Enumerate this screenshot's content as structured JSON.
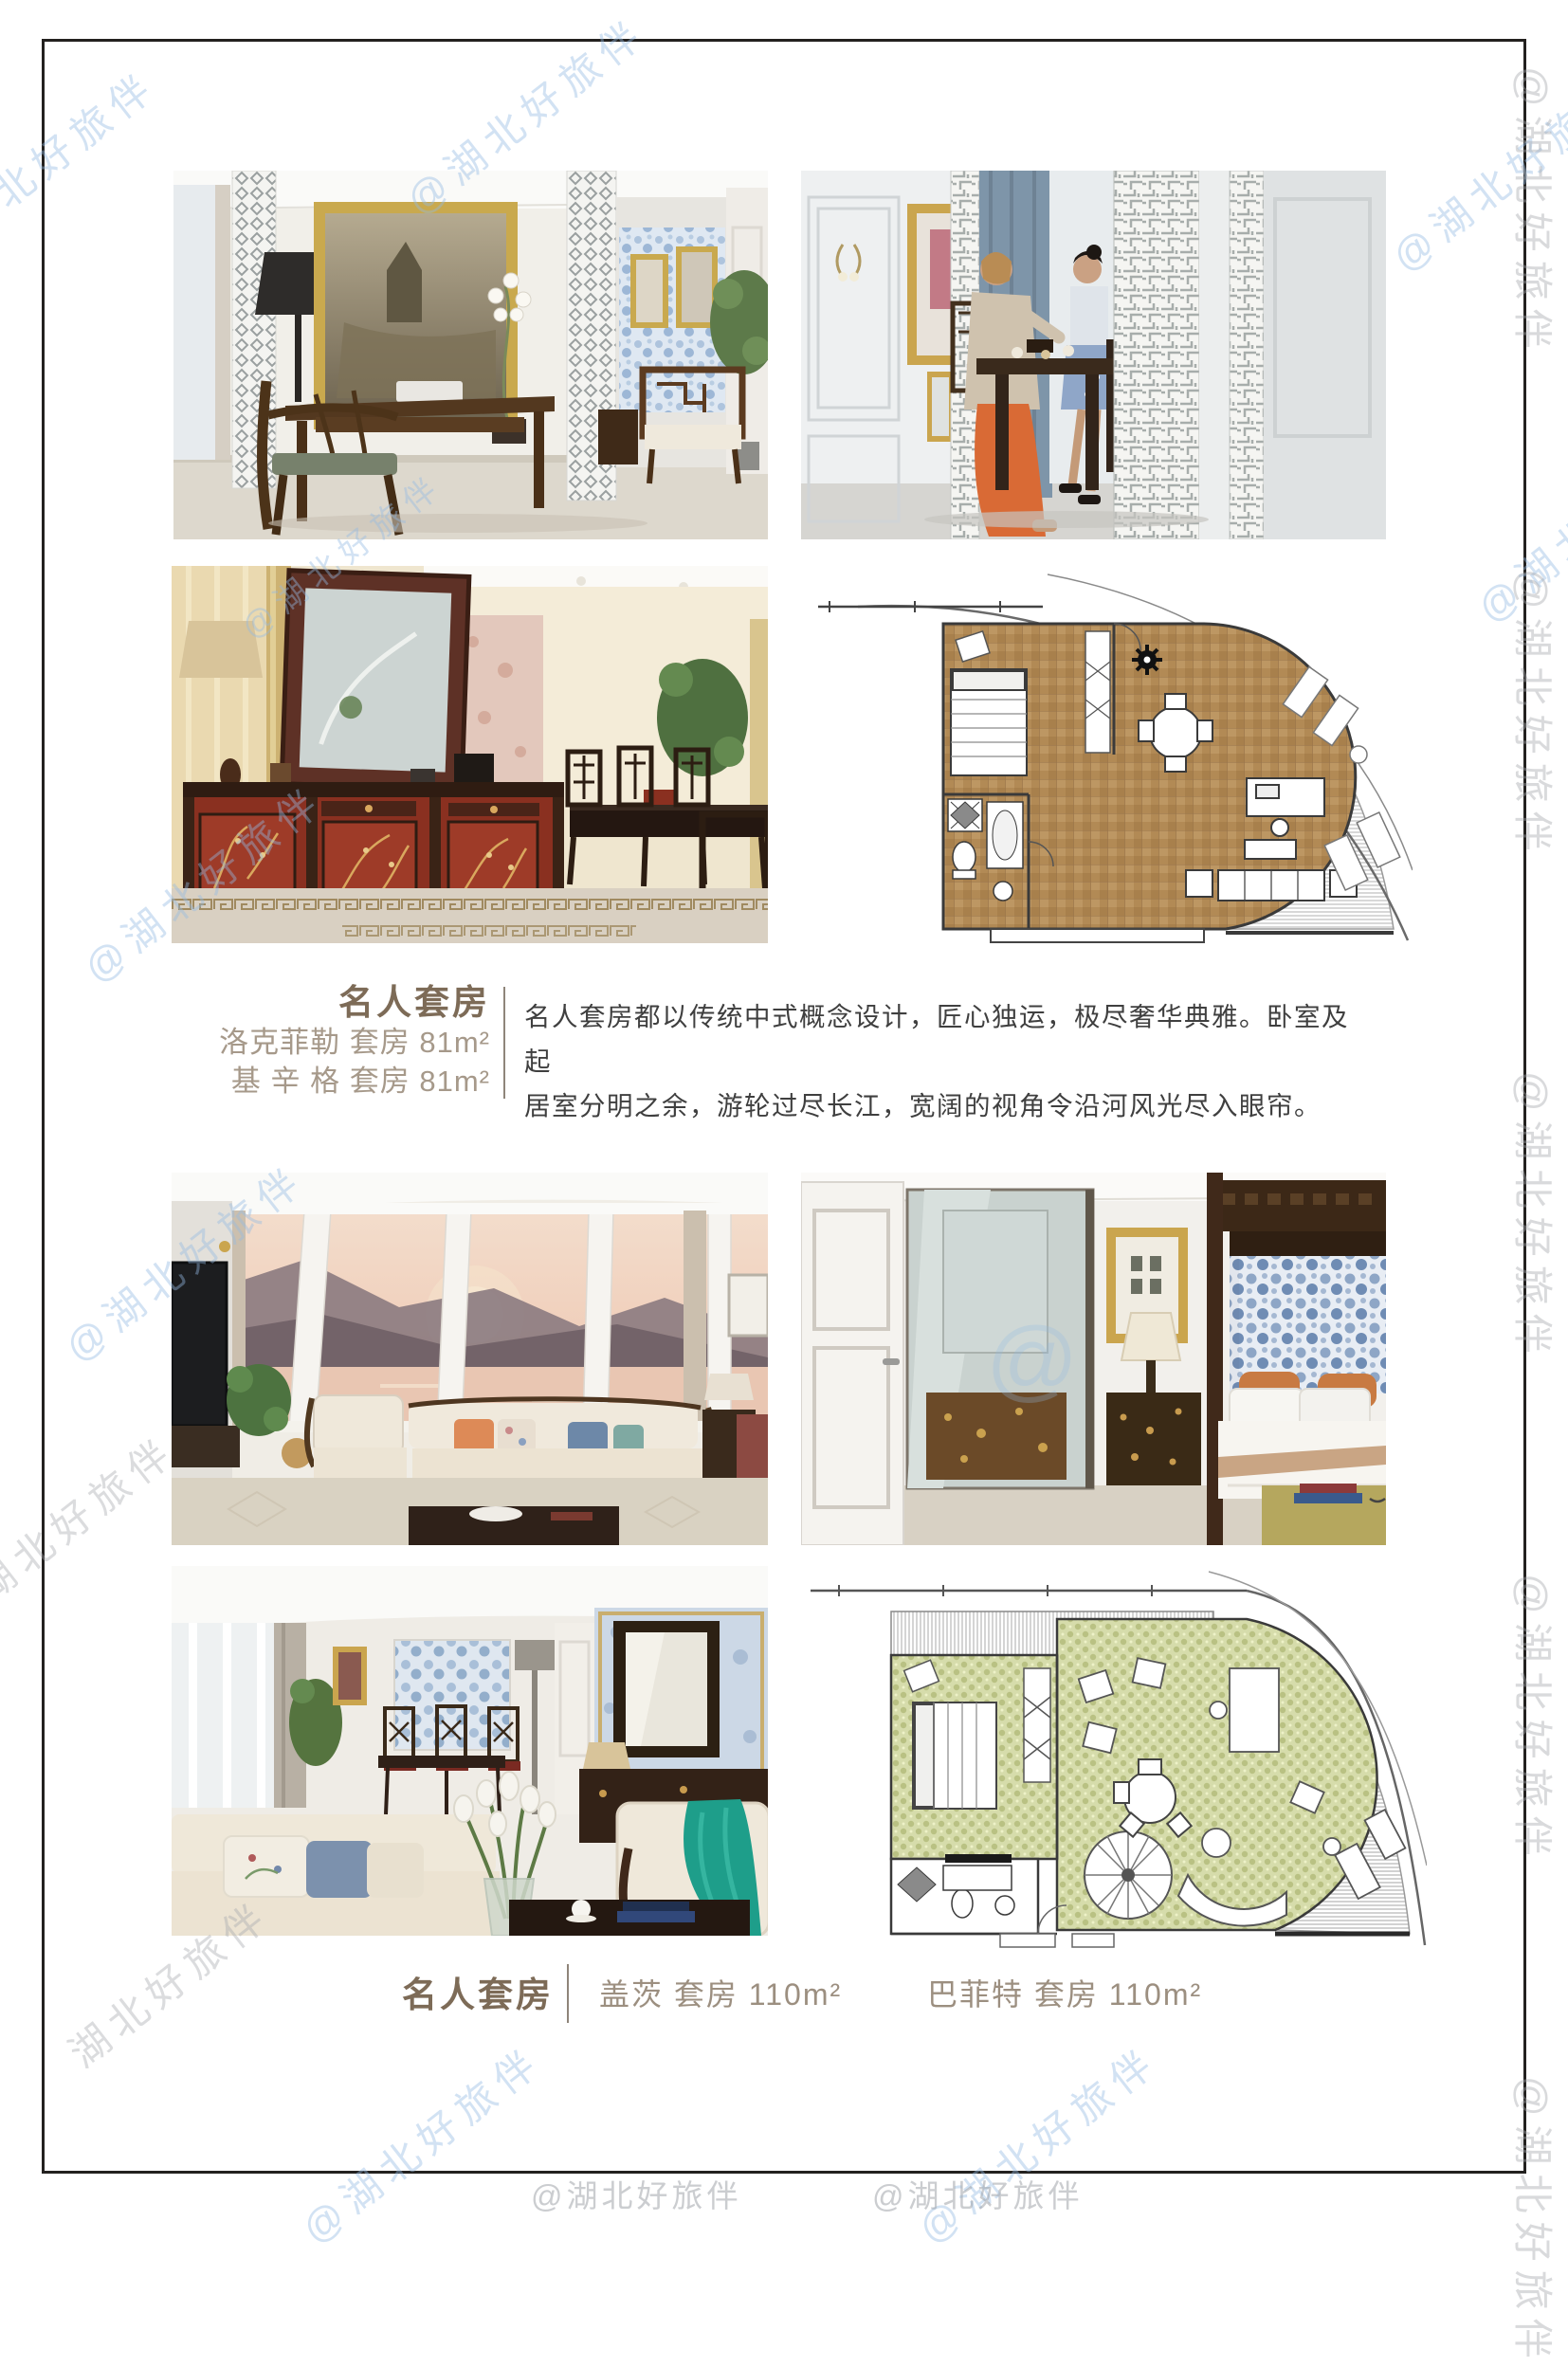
{
  "watermark": {
    "handle": "@湖北好旅伴",
    "name": "湖北好旅伴",
    "at_glyph": "@"
  },
  "section_celebrity_81": {
    "title": "名人套房",
    "suites": [
      {
        "name": "洛克菲勒 套房",
        "area": "81m²"
      },
      {
        "name": "基 辛 格 套房",
        "area": "81m²"
      }
    ],
    "description_lines": [
      "名人套房都以传统中式概念设计，匠心独运，极尽奢华典雅。卧室及起",
      "居室分明之余，游轮过尽长江，宽阔的视角令沿河风光尽入眼帘。"
    ]
  },
  "section_celebrity_110": {
    "title": "名人套房",
    "suites": [
      {
        "name": "盖茨 套房",
        "area": "110m²"
      },
      {
        "name": "巴菲特 套房",
        "area": "110m²"
      }
    ]
  },
  "colors": {
    "title_brown": "#7d6b57",
    "suite_text": "#a6998a",
    "body_text": "#3f3f3f",
    "divider": "#8f857a",
    "watermark_blue": "#94bae2",
    "watermark_gray": "#a5a8ac",
    "plan_floor_brown": "#b28a55",
    "plan_carpet_green": "#d6dcab"
  }
}
